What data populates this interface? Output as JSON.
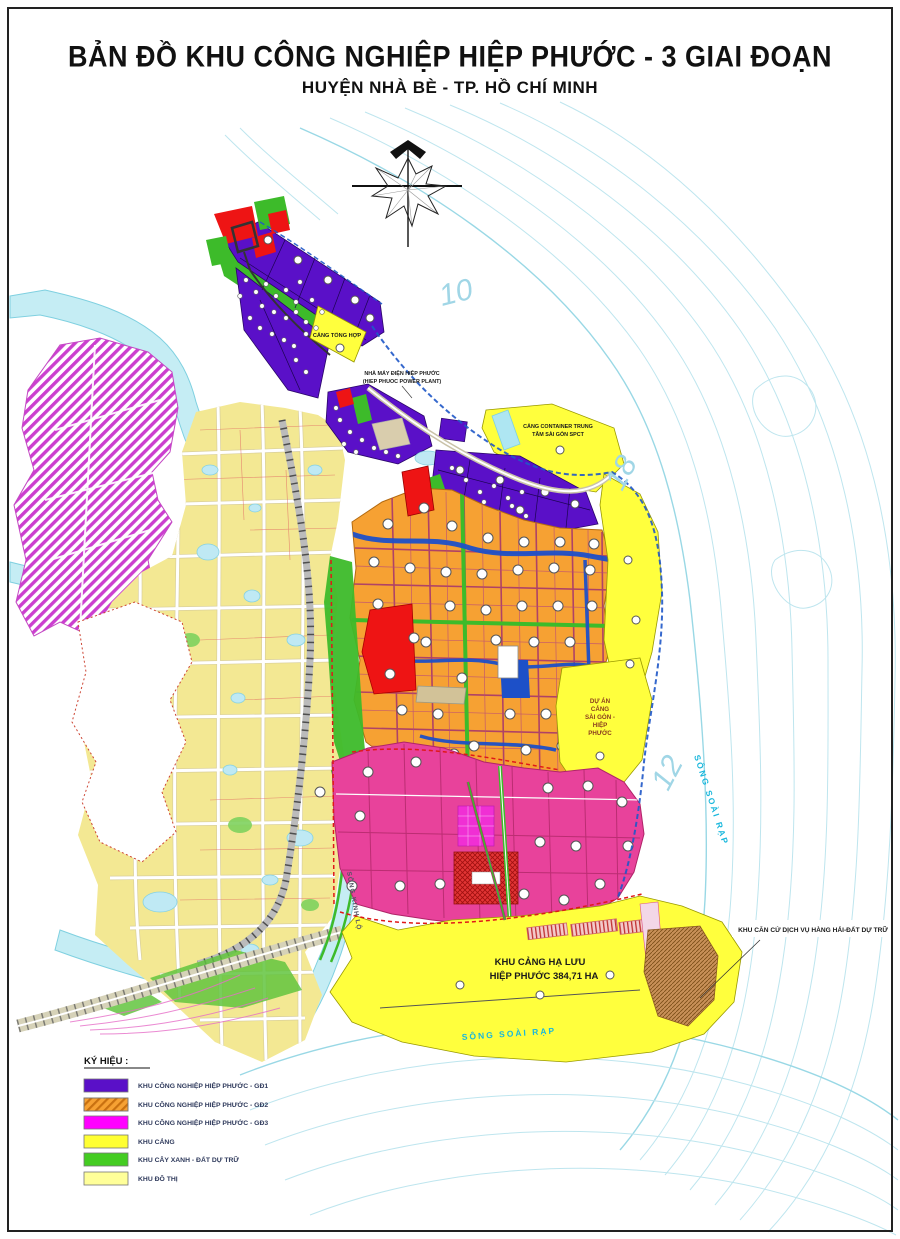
{
  "page": {
    "title_line1": "BẢN ĐỒ KHU CÔNG NGHIỆP HIỆP PHƯỚC - 3 GIAI ĐOẠN",
    "title_line2": "HUYỆN NHÀ BÈ - TP. HỒ CHÍ MINH"
  },
  "map": {
    "labels": {
      "cang_tong_hop": "CẢNG TỔNG HỢP",
      "power_plant_l1": "NHÀ MÁY ĐIỆN HIỆP PHƯỚC",
      "power_plant_l2": "(HIEP PHUOC POWER PLANT)",
      "spct_l1": "CẢNG CONTAINER TRUNG",
      "spct_l2": "TÂM SÀI GÒN SPCT",
      "du_an_l1": "DỰ ÁN",
      "du_an_l2": "CẢNG",
      "du_an_l3": "SÀI GÒN -",
      "du_an_l4": "HIỆP",
      "du_an_l5": "PHƯỚC",
      "khu_cang_l1": "KHU CẢNG HẠ LƯU",
      "khu_cang_l2": "HIỆP PHƯỚC 384,71 HA",
      "khu_can_cu": "KHU CĂN CỨ DỊCH VỤ HÀNG HẢI-ĐẤT DỰ TRỮ",
      "song_soai_rap_right": "SÔNG SOÀI RẠP",
      "song_soai_rap_bottom": "SÔNG SOÀI RẠP",
      "song_kinh_lo": "SÔNG KINH LỘ"
    },
    "depths": [
      "10",
      "18",
      "12"
    ]
  },
  "legend": {
    "title": "KÝ HIỆU :",
    "items": [
      {
        "label": "KHU CÔNG NGHIỆP HIỆP PHƯỚC - GĐ1",
        "color": "#5a10c8"
      },
      {
        "label": "KHU CÔNG NGHIỆP HIỆP PHƯỚC - GĐ2",
        "color": "#f6a133"
      },
      {
        "label": "KHU CÔNG NGHIỆP HIỆP PHƯỚC - GĐ3",
        "color": "#ff00ff"
      },
      {
        "label": "KHU CẢNG",
        "color": "#ffff33"
      },
      {
        "label": "KHU CÂY XANH - ĐẤT DỰ TRỮ",
        "color": "#44cc22"
      },
      {
        "label": "KHU ĐÔ THỊ",
        "color": "#ffff99"
      }
    ]
  },
  "colors": {
    "gd1_purple": "#5a10c8",
    "gd2_orange": "#f6a133",
    "gd3_pink": "#e8429b",
    "port_yellow": "#ffff3d",
    "green": "#44cc22",
    "urban_yellow": "#f3e893",
    "water": "#c5edf4",
    "canal_blue": "#1d50c8",
    "red_zone": "#ee1414",
    "river_contour": "#b7e3ed"
  }
}
